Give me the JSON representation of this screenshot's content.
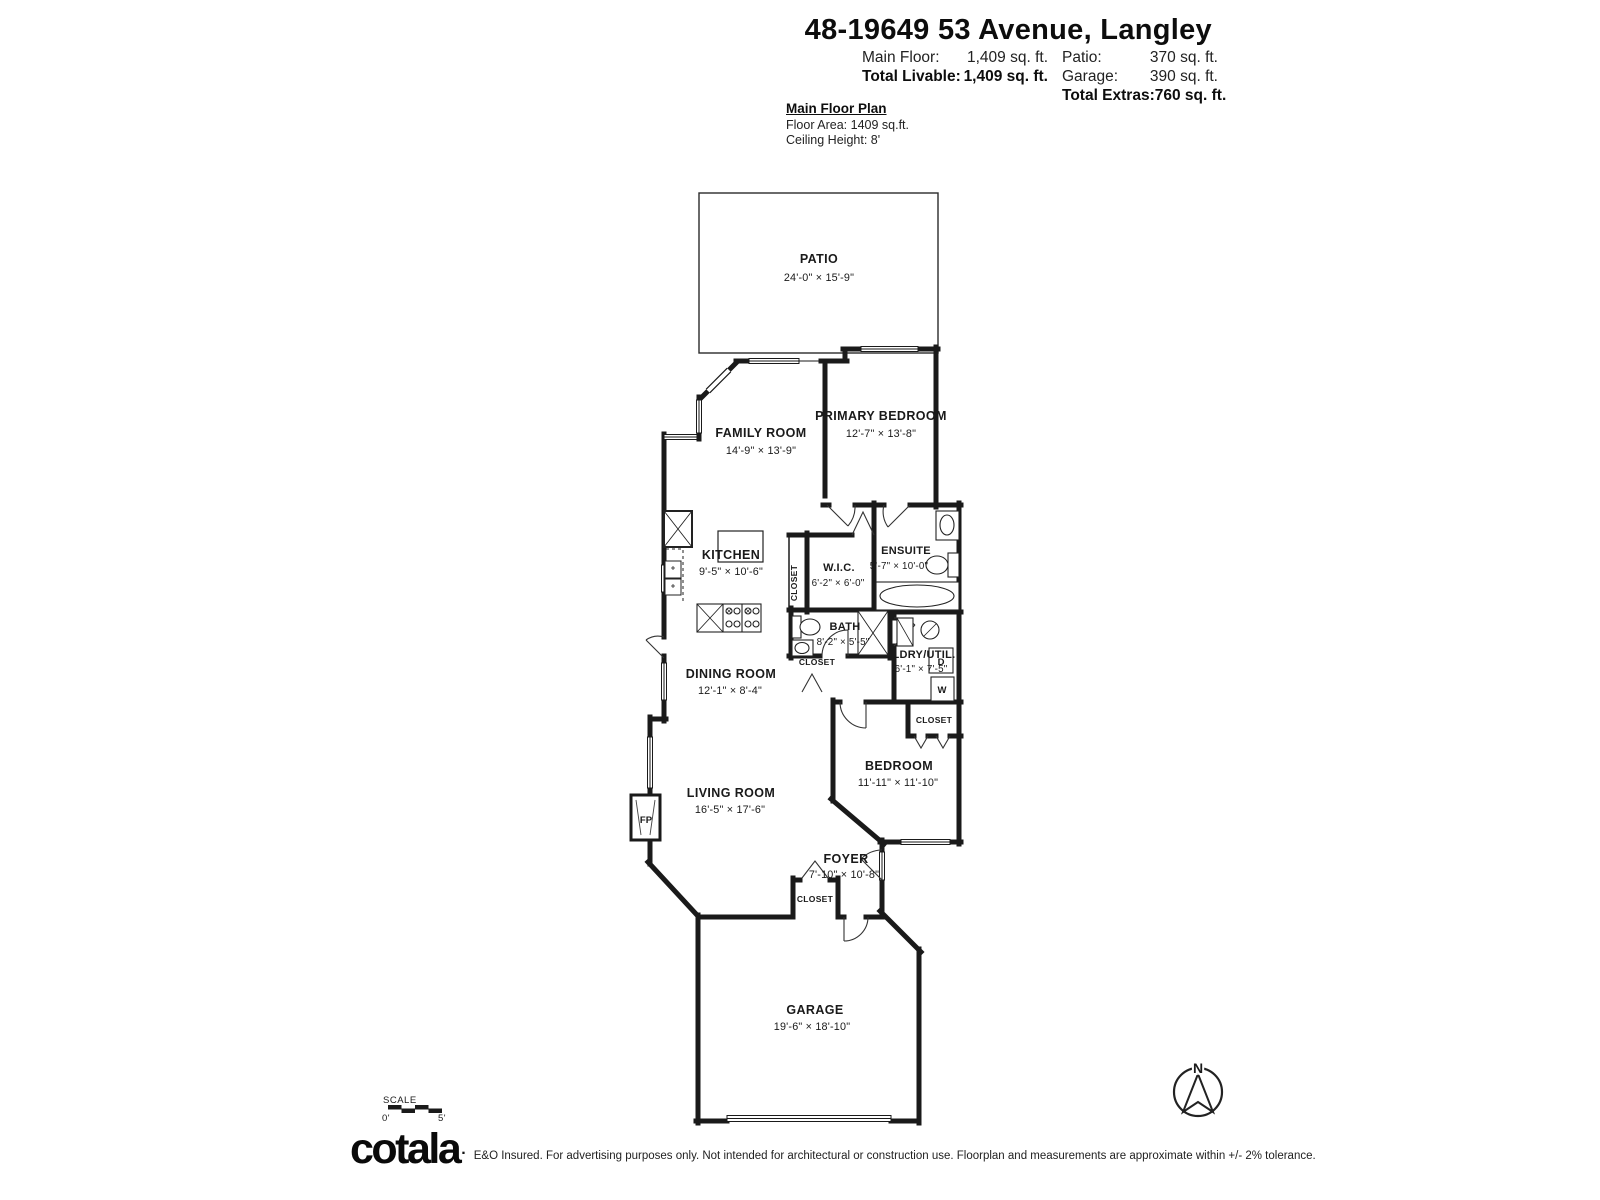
{
  "header": {
    "title": "48-19649 53 Avenue, Langley",
    "main_floor_label": "Main Floor:",
    "main_floor_value": "1,409 sq. ft.",
    "total_livable_label": "Total Livable:",
    "total_livable_value": "1,409 sq. ft.",
    "patio_label": "Patio:",
    "patio_value": "370 sq. ft.",
    "garage_label": "Garage:",
    "garage_value": "390 sq. ft.",
    "total_extras_label": "Total Extras:",
    "total_extras_value": "760 sq. ft."
  },
  "plan_info": {
    "title": "Main Floor Plan",
    "floor_area": "Floor Area: 1409 sq.ft.",
    "ceiling_height": "Ceiling Height: 8'"
  },
  "rooms": {
    "patio": {
      "name": "PATIO",
      "dims": "24'-0\" × 15'-9\""
    },
    "family": {
      "name": "FAMILY ROOM",
      "dims": "14'-9\" × 13'-9\""
    },
    "primary": {
      "name": "PRIMARY BEDROOM",
      "dims": "12'-7\" × 13'-8\""
    },
    "kitchen": {
      "name": "KITCHEN",
      "dims": "9'-5\" × 10'-6\""
    },
    "wic": {
      "name": "W.I.C.",
      "dims": "6'-2\" × 6'-0\""
    },
    "ensuite": {
      "name": "ENSUITE",
      "dims": "5'-7\" × 10'-0\""
    },
    "bath": {
      "name": "BATH",
      "dims": "8'-2\" × 5'-5\""
    },
    "ldry": {
      "name": "LDRY/UTIL.",
      "dims": "6'-1\" × 7'-5\""
    },
    "dining": {
      "name": "DINING ROOM",
      "dims": "12'-1\" × 8'-4\""
    },
    "living": {
      "name": "LIVING ROOM",
      "dims": "16'-5\" × 17'-6\""
    },
    "bedroom": {
      "name": "BEDROOM",
      "dims": "11'-11\" × 11'-10\""
    },
    "foyer": {
      "name": "FOYER",
      "dims": "7'-10\" × 10'-8\""
    },
    "garage": {
      "name": "GARAGE",
      "dims": "19'-6\" × 18'-10\""
    }
  },
  "labels": {
    "closet": "CLOSET",
    "fp": "FP",
    "washer": "W",
    "dryer": "D",
    "north": "N"
  },
  "scale": {
    "label": "SCALE",
    "start": "0'",
    "end": "5'"
  },
  "footer": {
    "logo": "cotala",
    "logo_mark": ".",
    "disclaimer": "E&O Insured. For advertising purposes only. Not intended for architectural or construction use. Floorplan and measurements are approximate within +/- 2% tolerance."
  },
  "colors": {
    "wall": "#1a1a1a",
    "background": "#ffffff"
  }
}
